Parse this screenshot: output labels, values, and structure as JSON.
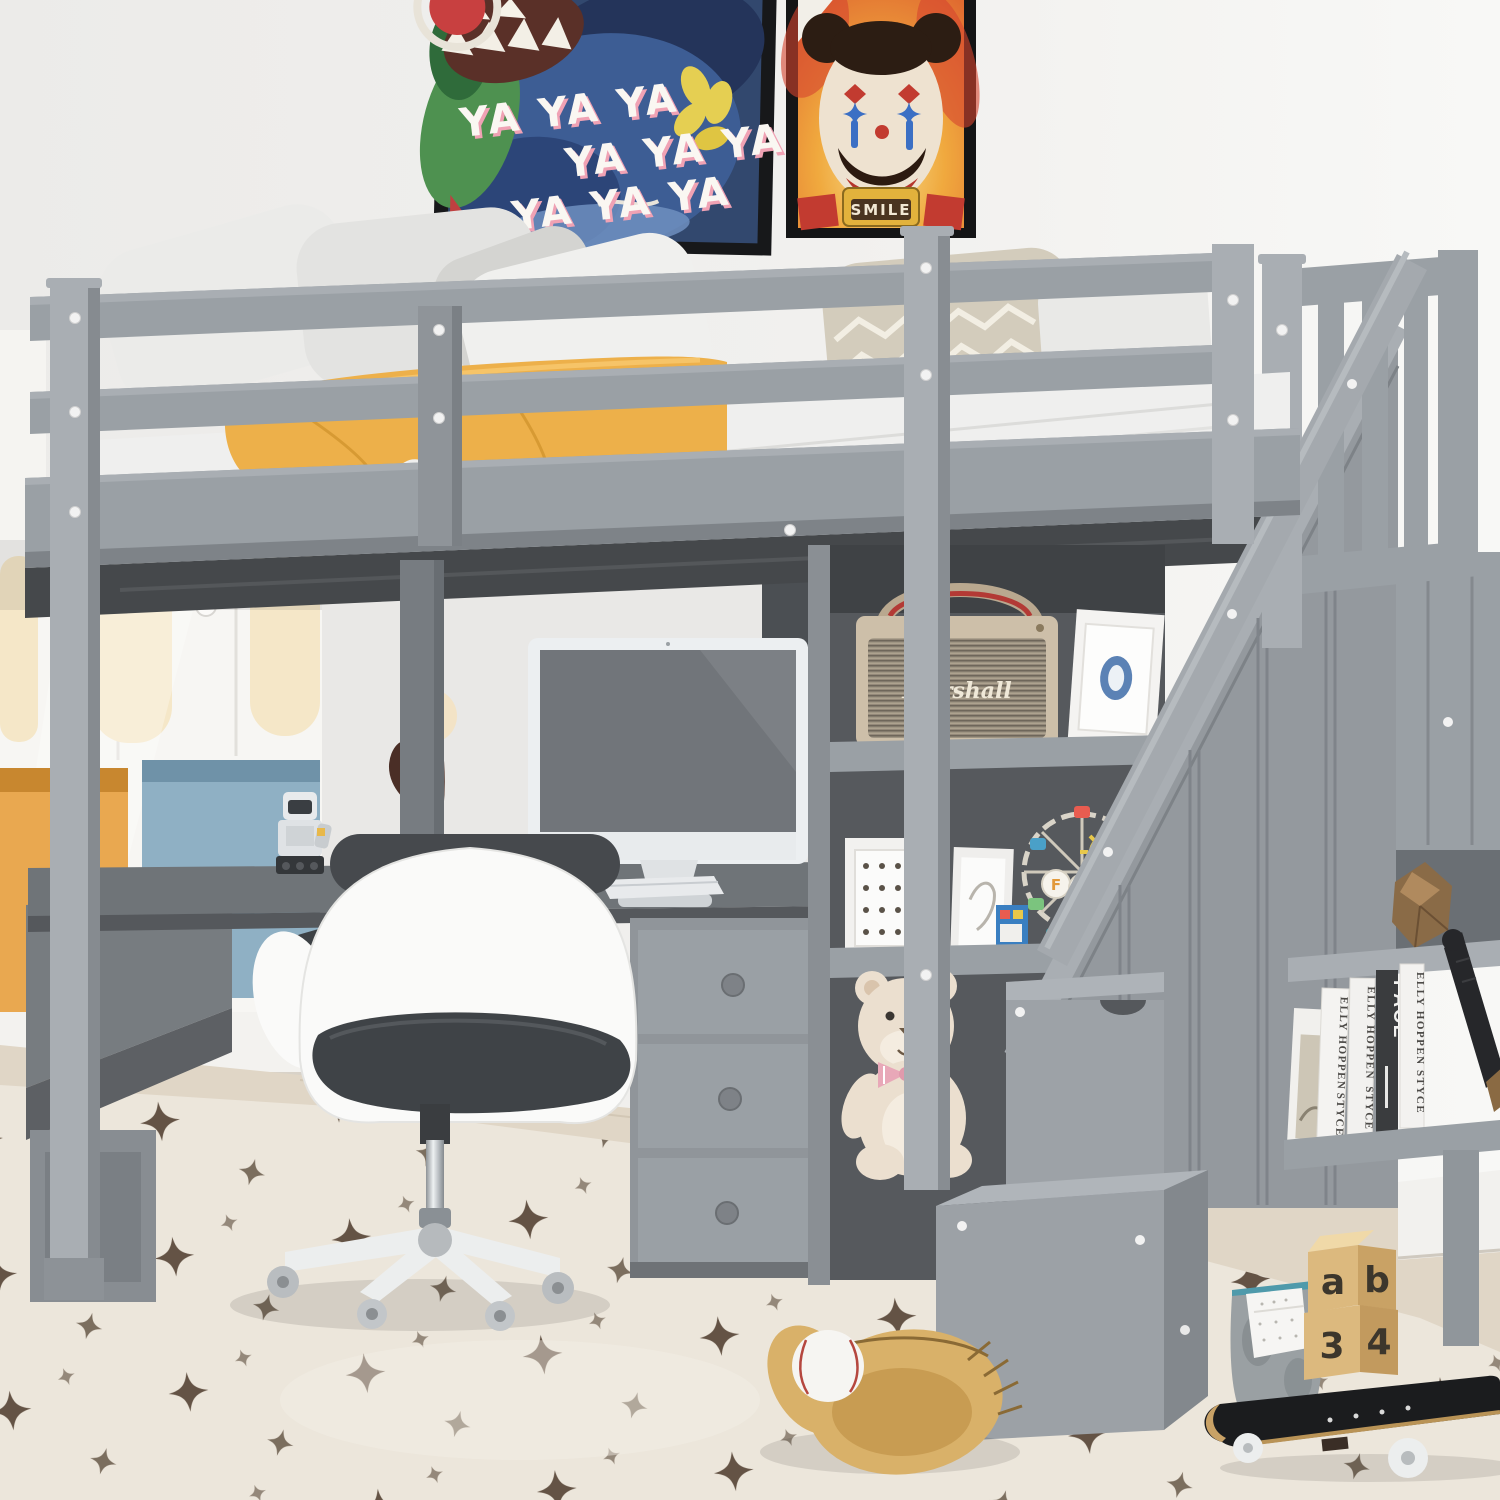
{
  "scene": {
    "type": "product-photo",
    "subject": "Gray twin loft bed with storage staircase, built-in L-shaped desk, bookshelves, office chair and toys in a kids bedroom",
    "colors": {
      "bed_gray": "#9aa0a5",
      "bed_gray_light": "#a9aeb3",
      "bed_gray_dark": "#7e8388",
      "bed_gray_deep": "#55585c",
      "shelf_interior": "#56595d",
      "wall": "#f1f0ee",
      "wood_floor": "#e0d6c6",
      "rug_cream": "#ece6db",
      "rug_star_brown": "#4c3a2a",
      "blanket_yellow": "#edb04a",
      "mattress_white": "#efefee",
      "pillow_white": "#ebebe9",
      "pillow_chevron": "#d3ccbc",
      "wardrobe_white": "#f7f6f3",
      "arch_cream": "#f5e7c8",
      "niche_orange": "#e9a850",
      "niche_blue": "#8fb0c4",
      "chair_white": "#fafaf9",
      "chair_seat_gray": "#3f4347",
      "speaker_cream": "#cdbfa9",
      "speaker_grille": "#8f8678",
      "teddy_cream": "#ebdfcf",
      "toy_wood": "#dcb97e",
      "glove_tan": "#d9b169",
      "skateboard_black": "#1b1c1e",
      "poster_navy": "#32486e",
      "poster_fire_orange": "#ee8c3a"
    }
  },
  "posters": {
    "graffiti": {
      "lines": [
        "YA YA YA",
        "YA YA YA",
        "YA YA YA"
      ]
    },
    "clown_bear": {
      "sign_text": "SMILE"
    }
  },
  "speaker": {
    "logo_script": "Marshall"
  },
  "ferris_wheel": {
    "sign_letters": [
      "F",
      "U",
      "N"
    ]
  },
  "bookshelf_books": {
    "spines": [
      {
        "title": "ELLY HOPPEN",
        "subtitle": "STYCE"
      },
      {
        "title": "ELLY HOPPEN",
        "subtitle": "STYCE"
      },
      {
        "title": "PACE",
        "subtitle": ""
      },
      {
        "title": "ELLY HOPPEN",
        "subtitle": "STYCE"
      }
    ]
  },
  "toy_blocks": {
    "top_letters": [
      "a",
      "b"
    ],
    "bottom_numbers": [
      "3",
      "4"
    ]
  }
}
